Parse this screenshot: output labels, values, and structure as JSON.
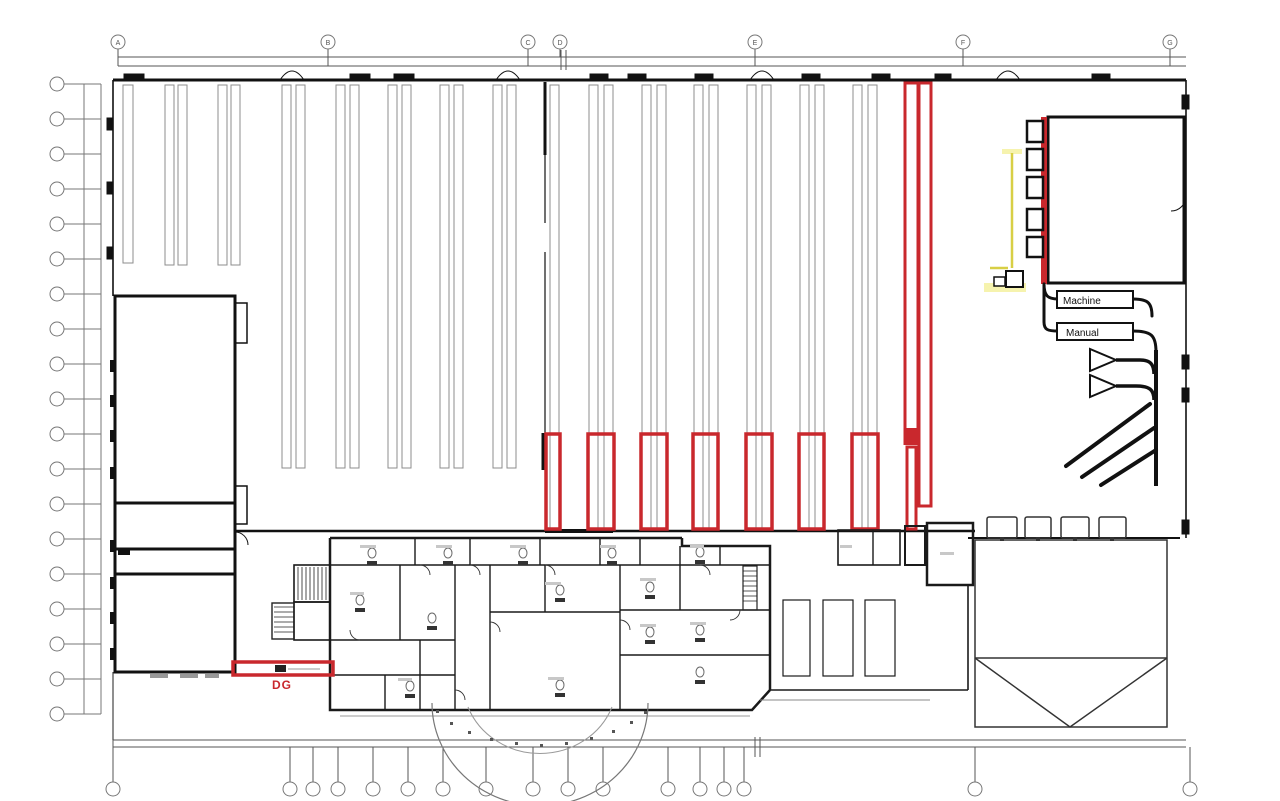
{
  "plan": {
    "grid": {
      "top_labels": [
        "A",
        "B",
        "C",
        "D",
        "E",
        "F",
        "G"
      ]
    },
    "labels": {
      "machine": "Machine",
      "manual": "Manual",
      "dg": "DG"
    },
    "colors": {
      "markup_red": "#c9282d",
      "markup_yellow": "#d8cf45",
      "markup_yellow_pale": "#f6f3ae",
      "ink": "#111111",
      "rack_gray": "#8c8c8c"
    }
  }
}
